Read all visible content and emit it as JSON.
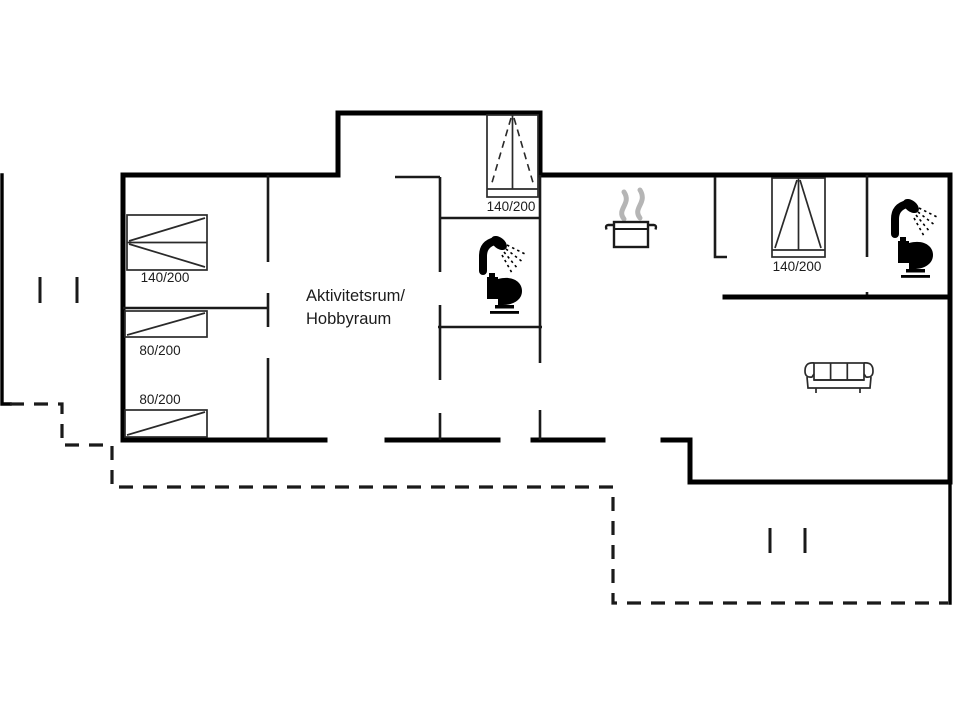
{
  "floorplan": {
    "colors": {
      "line": "#000000",
      "steam": "#b5b5b5",
      "background": "#ffffff"
    },
    "labels": {
      "activity_room_line1": "Aktivitetsrum/",
      "activity_room_line2": "Hobbyraum",
      "bed_double_left": "140/200",
      "bed_single_upper": "80/200",
      "bed_single_lower": "80/200",
      "bed_double_middle": "140/200",
      "bed_double_right": "140/200"
    },
    "icons": [
      "shower-icon",
      "toilet-icon",
      "cooking-pot-icon",
      "steam-icon",
      "sofa-icon",
      "window-mark"
    ]
  }
}
